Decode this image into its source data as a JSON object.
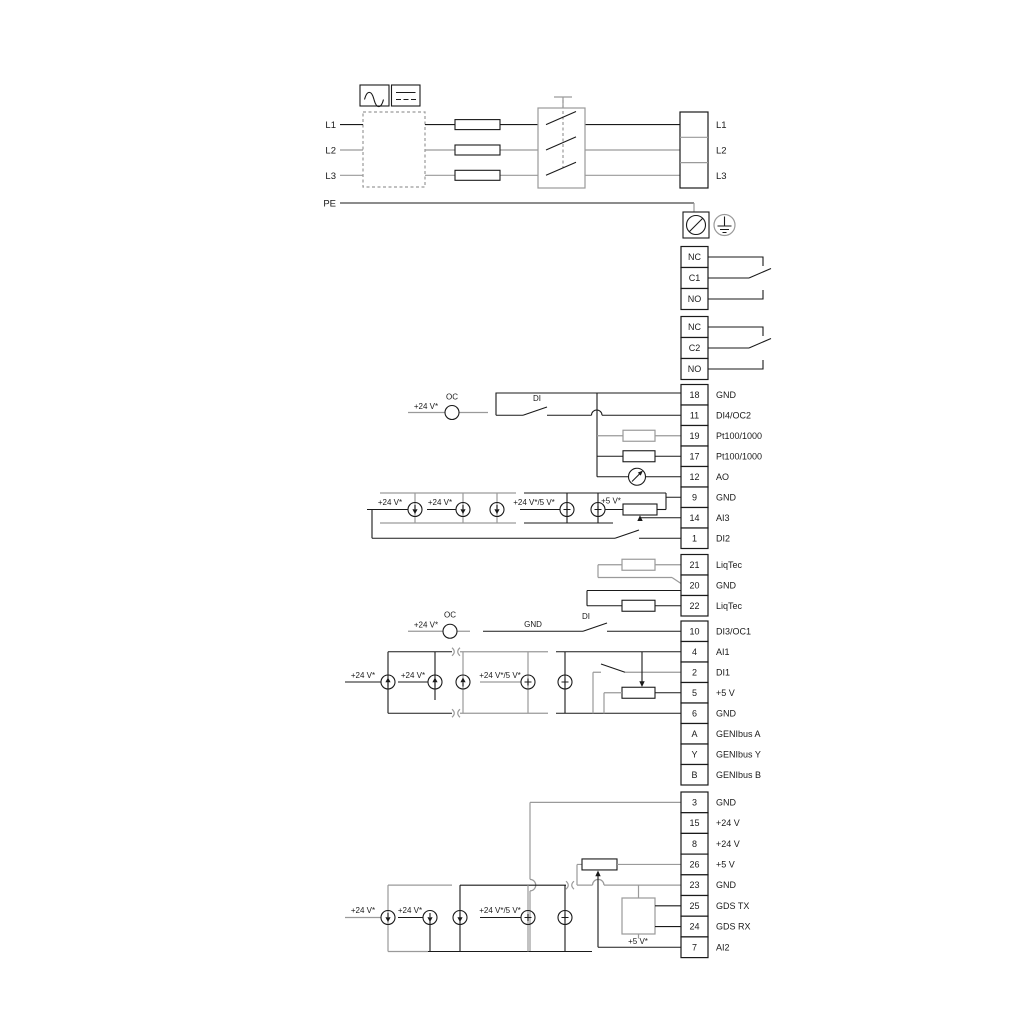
{
  "doc": {
    "type": "wiring-diagram",
    "description": "Pump drive power and control terminal wiring diagram"
  },
  "colors": {
    "wire_black": "#1a1a1a",
    "wire_gray": "#9a9a9a",
    "background": "#ffffff"
  },
  "power": {
    "left_labels": [
      "L1",
      "L2",
      "L3",
      "PE"
    ],
    "right_labels": [
      "L1",
      "L2",
      "L3"
    ]
  },
  "relays": {
    "relay1": [
      "NC",
      "C1",
      "NO"
    ],
    "relay2": [
      "NC",
      "C2",
      "NO"
    ]
  },
  "terminals": {
    "io1": [
      {
        "num": "18",
        "label": "GND"
      },
      {
        "num": "11",
        "label": "DI4/OC2"
      },
      {
        "num": "19",
        "label": "Pt100/1000"
      },
      {
        "num": "17",
        "label": "Pt100/1000"
      },
      {
        "num": "12",
        "label": "AO"
      },
      {
        "num": "9",
        "label": "GND"
      },
      {
        "num": "14",
        "label": "AI3"
      },
      {
        "num": "1",
        "label": "DI2"
      }
    ],
    "liqtec": [
      {
        "num": "21",
        "label": "LiqTec"
      },
      {
        "num": "20",
        "label": "GND"
      },
      {
        "num": "22",
        "label": "LiqTec"
      }
    ],
    "io2": [
      {
        "num": "10",
        "label": "DI3/OC1"
      },
      {
        "num": "4",
        "label": "AI1"
      },
      {
        "num": "2",
        "label": "DI1"
      },
      {
        "num": "5",
        "label": "+5 V"
      },
      {
        "num": "6",
        "label": "GND"
      },
      {
        "num": "A",
        "label": "GENIbus A"
      },
      {
        "num": "Y",
        "label": "GENIbus Y"
      },
      {
        "num": "B",
        "label": "GENIbus B"
      }
    ],
    "io3": [
      {
        "num": "3",
        "label": "GND"
      },
      {
        "num": "15",
        "label": "+24 V"
      },
      {
        "num": "8",
        "label": "+24 V"
      },
      {
        "num": "26",
        "label": "+5 V"
      },
      {
        "num": "23",
        "label": "GND"
      },
      {
        "num": "25",
        "label": "GDS TX"
      },
      {
        "num": "24",
        "label": "GDS RX"
      },
      {
        "num": "7",
        "label": "AI2"
      }
    ]
  },
  "ann": {
    "v24": "+24 V*",
    "v24_5": "+24 V*/5 V*",
    "v5": "+5 V*",
    "oc": "OC",
    "di": "DI",
    "gnd": "GND"
  }
}
